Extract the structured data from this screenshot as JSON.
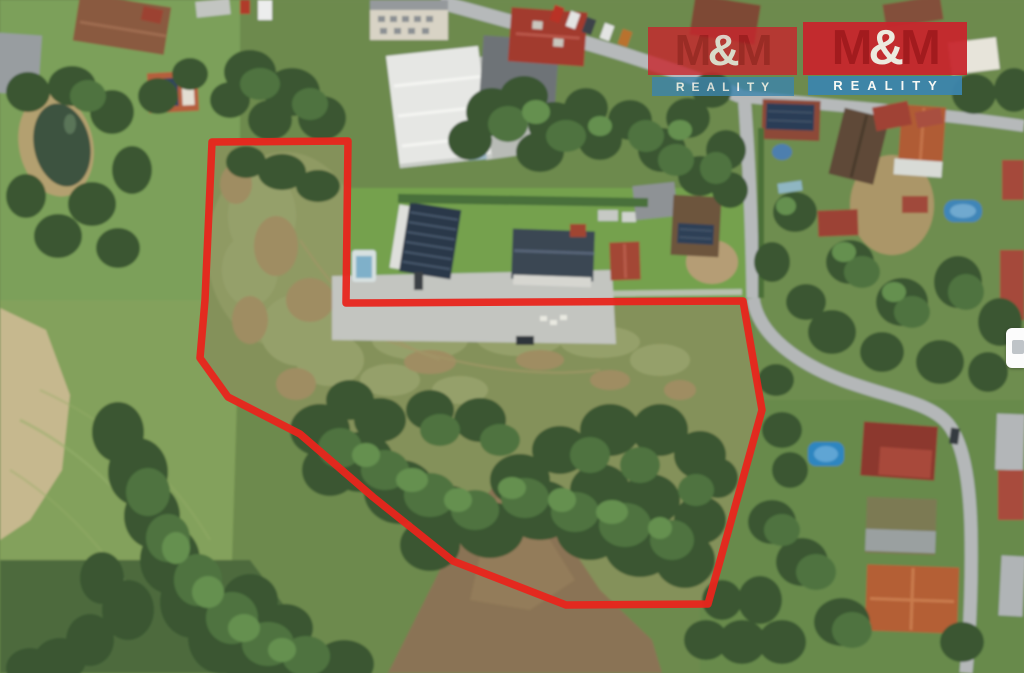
{
  "branding": {
    "logo_left": {
      "m1": "M",
      "amp": "&",
      "m2": "M",
      "reality": "REALITY"
    },
    "logo_right": {
      "m1": "M",
      "amp": "&",
      "m2": "M",
      "reality": "REALITY"
    },
    "brand_red": "#c8262d",
    "brand_dark_red": "#a6151c",
    "brand_blue": "#3c85ad",
    "brand_text": "#ffffff"
  },
  "boundary": {
    "points": "212,142 348,141 346,303 743,301 762,410 708,604 566,605 453,561 373,497 300,434 228,397 200,358 205,300",
    "color": "#e8251c"
  }
}
